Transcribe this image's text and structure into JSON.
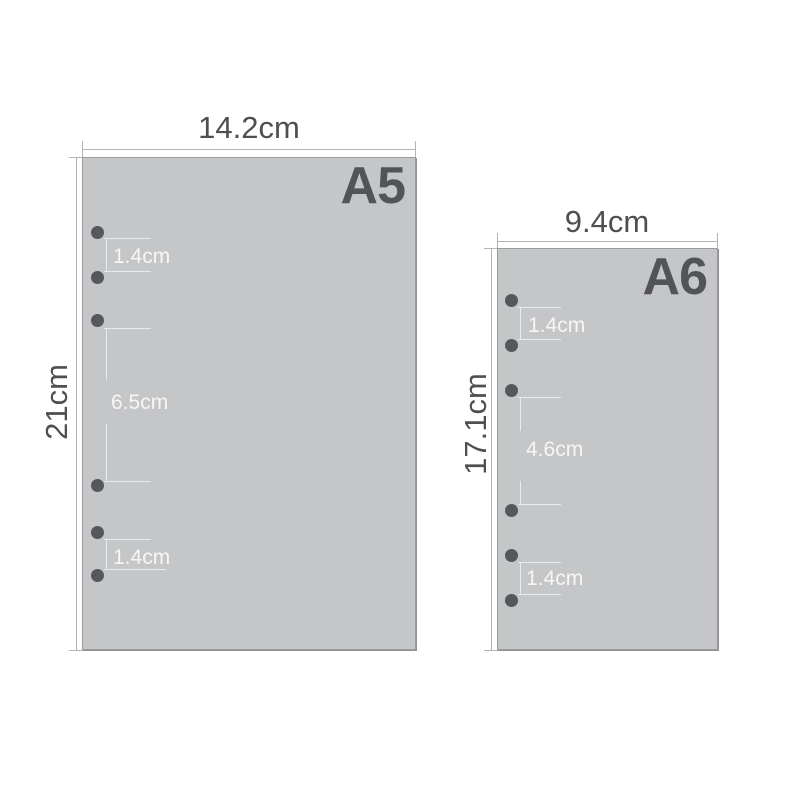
{
  "diagram_title": "Paper size diagram",
  "colors": {
    "background": "#ffffff",
    "sheet_fill": "#c5c6c8",
    "sheet_border": "#9b9c9e",
    "hole": "#56575a",
    "dimension_line": "#b3b4b6",
    "dimension_text": "#4e4f52",
    "sheet_label_text": "#53545a",
    "inner_annotation_text": "#f6f6f6"
  },
  "a5": {
    "label": "A5",
    "width": "14.2cm",
    "height": "21cm",
    "hole_count": 6,
    "spacing_top": "1.4cm",
    "spacing_middle": "6.5cm",
    "spacing_bottom": "1.4cm"
  },
  "a6": {
    "label": "A6",
    "width": "9.4cm",
    "height": "17.1cm",
    "hole_count": 6,
    "spacing_top": "1.4cm",
    "spacing_middle": "4.6cm",
    "spacing_bottom": "1.4cm"
  }
}
